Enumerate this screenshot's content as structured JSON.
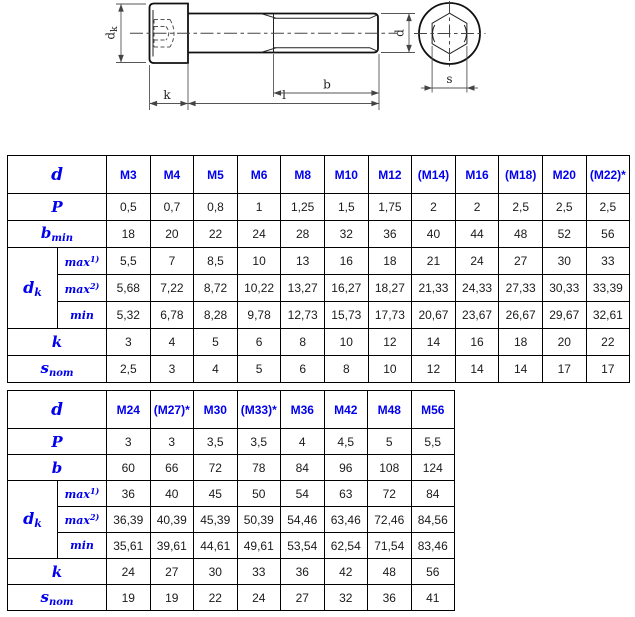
{
  "drawing": {
    "dim_labels": {
      "head_diameter": {
        "main": "d",
        "sub": "k"
      },
      "head_height": "k",
      "total_length": "l",
      "thread_length": "b",
      "thread_diameter": "d",
      "socket_size": "s"
    }
  },
  "colors": {
    "label_blue": "#0000ee",
    "value_black": "#1a1a1a",
    "line_black": "#111111"
  },
  "table1": {
    "corner_label": {
      "main": "d"
    },
    "columns": [
      "M3",
      "M4",
      "M5",
      "M6",
      "M8",
      "M10",
      "M12",
      "(M14)",
      "M16",
      "(M18)",
      "M20",
      "(M22)*"
    ],
    "rows": [
      {
        "kind": "simple",
        "label": {
          "main": "P"
        },
        "values": [
          "0,5",
          "0,7",
          "0,8",
          "1",
          "1,25",
          "1,5",
          "1,75",
          "2",
          "2",
          "2,5",
          "2,5",
          "2,5"
        ]
      },
      {
        "kind": "simple",
        "label": {
          "main": "b",
          "sub": "min"
        },
        "values": [
          "18",
          "20",
          "22",
          "24",
          "28",
          "32",
          "36",
          "40",
          "44",
          "48",
          "52",
          "56"
        ]
      },
      {
        "kind": "group",
        "label": {
          "main": "d",
          "sub": "k"
        },
        "subrows": [
          {
            "label": {
              "main": "max",
              "sup": "1)"
            },
            "values": [
              "5,5",
              "7",
              "8,5",
              "10",
              "13",
              "16",
              "18",
              "21",
              "24",
              "27",
              "30",
              "33"
            ]
          },
          {
            "label": {
              "main": "max",
              "sup": "2)"
            },
            "values": [
              "5,68",
              "7,22",
              "8,72",
              "10,22",
              "13,27",
              "16,27",
              "18,27",
              "21,33",
              "24,33",
              "27,33",
              "30,33",
              "33,39"
            ]
          },
          {
            "label": {
              "main": "min"
            },
            "values": [
              "5,32",
              "6,78",
              "8,28",
              "9,78",
              "12,73",
              "15,73",
              "17,73",
              "20,67",
              "23,67",
              "26,67",
              "29,67",
              "32,61"
            ]
          }
        ]
      },
      {
        "kind": "simple",
        "label": {
          "main": "k"
        },
        "values": [
          "3",
          "4",
          "5",
          "6",
          "8",
          "10",
          "12",
          "14",
          "16",
          "18",
          "20",
          "22"
        ]
      },
      {
        "kind": "simple",
        "label": {
          "main": "s",
          "sub": "nom"
        },
        "values": [
          "2,5",
          "3",
          "4",
          "5",
          "6",
          "8",
          "10",
          "12",
          "14",
          "14",
          "17",
          "17"
        ]
      }
    ]
  },
  "table2": {
    "corner_label": {
      "main": "d"
    },
    "columns": [
      "M24",
      "(M27)*",
      "M30",
      "(M33)*",
      "M36",
      "M42",
      "M48",
      "M56"
    ],
    "rows": [
      {
        "kind": "simple",
        "label": {
          "main": "P"
        },
        "values": [
          "3",
          "3",
          "3,5",
          "3,5",
          "4",
          "4,5",
          "5",
          "5,5"
        ]
      },
      {
        "kind": "simple",
        "label": {
          "main": "b"
        },
        "values": [
          "60",
          "66",
          "72",
          "78",
          "84",
          "96",
          "108",
          "124"
        ]
      },
      {
        "kind": "group",
        "label": {
          "main": "d",
          "sub": "k"
        },
        "subrows": [
          {
            "label": {
              "main": "max",
              "sup": "1)"
            },
            "values": [
              "36",
              "40",
              "45",
              "50",
              "54",
              "63",
              "72",
              "84"
            ]
          },
          {
            "label": {
              "main": "max",
              "sup": "2)"
            },
            "values": [
              "36,39",
              "40,39",
              "45,39",
              "50,39",
              "54,46",
              "63,46",
              "72,46",
              "84,56"
            ]
          },
          {
            "label": {
              "main": "min"
            },
            "values": [
              "35,61",
              "39,61",
              "44,61",
              "49,61",
              "53,54",
              "62,54",
              "71,54",
              "83,46"
            ]
          }
        ]
      },
      {
        "kind": "simple",
        "label": {
          "main": "k"
        },
        "values": [
          "24",
          "27",
          "30",
          "33",
          "36",
          "42",
          "48",
          "56"
        ]
      },
      {
        "kind": "simple",
        "label": {
          "main": "s",
          "sub": "nom"
        },
        "values": [
          "19",
          "19",
          "22",
          "24",
          "27",
          "32",
          "36",
          "41"
        ]
      }
    ]
  }
}
